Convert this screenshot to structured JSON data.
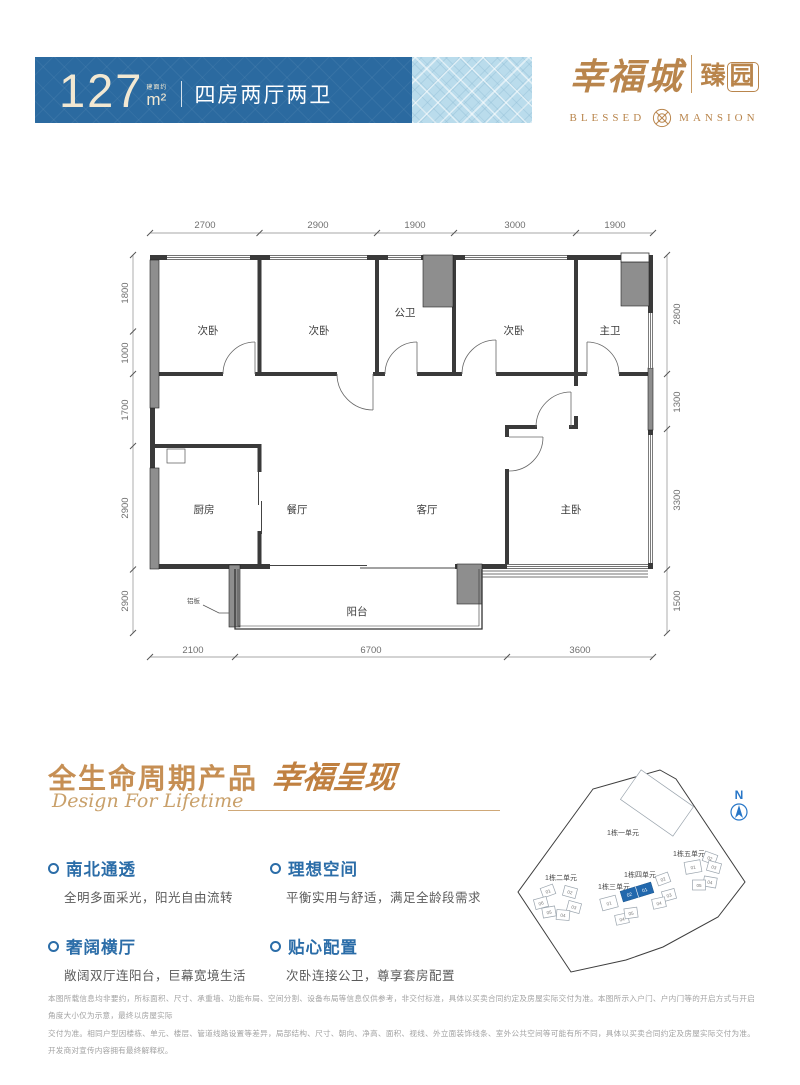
{
  "colors": {
    "banner_blue": "#2b6aa0",
    "banner_light": "#badcec",
    "gold": "#b9854c",
    "heading_gold": "#c68f54",
    "feature_blue": "#2b6da8",
    "highlight_blue": "#2268ad",
    "north_blue": "#2776c7"
  },
  "header": {
    "area": "127",
    "area_prefix": "建面约",
    "area_unit": "m²",
    "layout": "四房两厅两卫"
  },
  "logo": {
    "cn_main": "幸福城",
    "cn_sub_1": "臻",
    "cn_sub_2": "园",
    "en_left": "BLESSED",
    "en_right": "MANSION"
  },
  "plan": {
    "dims": {
      "top": [
        "2700",
        "2900",
        "1900",
        "3000",
        "1900"
      ],
      "left": [
        "1800",
        "1000",
        "1700",
        "2900",
        "1500"
      ],
      "right": [
        "2800",
        "1300",
        "3300",
        "1500"
      ],
      "bottom": [
        "2100",
        "6700",
        "3600"
      ]
    },
    "rooms": [
      "次卧",
      "次卧",
      "公卫",
      "次卧",
      "主卫",
      "厨房",
      "餐厅",
      "客厅",
      "主卧",
      "阳台"
    ],
    "annotation": "铝板"
  },
  "section": {
    "title_cn": "全生命周期产品",
    "title_script": "幸福呈现",
    "subtitle_en": "Design For Lifetime"
  },
  "features": [
    {
      "title": "南北通透",
      "desc": "全明多面采光，阳光自由流转"
    },
    {
      "title": "理想空间",
      "desc": "平衡实用与舒适，满足全龄段需求"
    },
    {
      "title": "奢阔横厅",
      "desc": "敞阔双厅连阳台，巨幕宽境生活"
    },
    {
      "title": "贴心配置",
      "desc": "次卧连接公卫，尊享套房配置"
    }
  ],
  "site_plan": {
    "north": "N",
    "clusters": [
      "1栋一单元",
      "1栋二单元",
      "1栋三单元",
      "1栋四单元",
      "1栋五单元"
    ],
    "units": {
      "b2": [
        "01",
        "02",
        "03",
        "04",
        "05",
        "06"
      ],
      "b3": [
        "01",
        "04",
        "05"
      ],
      "b3_highlight": [
        "02",
        "01"
      ],
      "b4": [
        "02",
        "03",
        "04"
      ],
      "b5": [
        "01",
        "02",
        "03",
        "04",
        "05"
      ]
    }
  },
  "disclaimer": {
    "line1": "本图所载信息均非要约，所标面积、尺寸、承重墙、功能布局、空间分割、设备布局等信息仅供参考，非交付标准，具体以买卖合同约定及房屋实际交付为准。本图所示入户门、户内门等的开启方式与开启角度大小仅为示意，最终以房屋实际",
    "line2": "交付为准。相同户型因楼栋、单元、楼层、管道线路设置等差异，局部结构、尺寸、朝向、净高、面积、视线、外立面装饰线条、室外公共空间等可能有所不同，具体以买卖合同约定及房屋实际交付为准。开发商对宣传内容拥有最终解释权。"
  }
}
